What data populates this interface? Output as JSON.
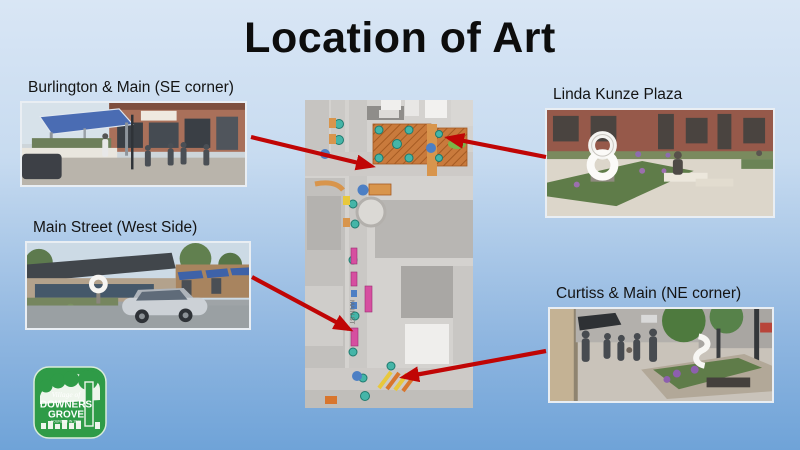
{
  "slide": {
    "title": "Location of Art",
    "background_top": "#d9e6f5",
    "background_bottom": "#6fa3d8"
  },
  "locations": [
    {
      "label": "Burlington & Main (SE corner)"
    },
    {
      "label": "Linda Kunze Plaza"
    },
    {
      "label": "Main Street (West Side)"
    },
    {
      "label": "Curtiss & Main (NE corner)"
    }
  ],
  "map": {
    "street_label": "MAIN ST",
    "arrow_color": "#c00505"
  },
  "logo": {
    "village_of": "Village of",
    "name_line1": "DOWNERS",
    "name_line2": "GROVE",
    "founded": "FOUNDED IN 1832",
    "color": "#2f9b47"
  }
}
